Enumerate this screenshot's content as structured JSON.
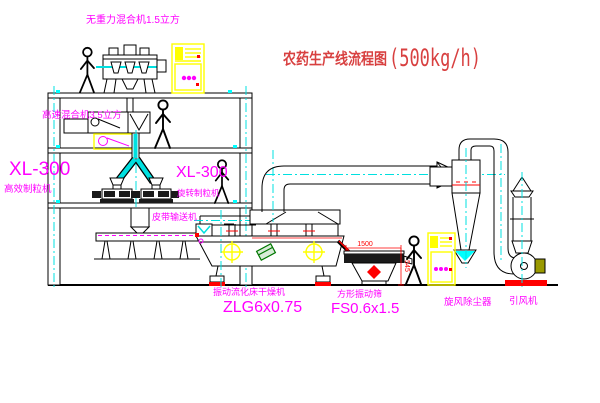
{
  "title": {
    "name": "农药生产线流程图",
    "capacity": "(500kg/h)"
  },
  "labels": {
    "gravity_mixer": "无重力混合机1.5立方",
    "high_speed_mixer": "高速混合机3.5立方",
    "granulator_left_model": "XL-300",
    "granulator_left_name": "高效制粒机",
    "granulator_right_model": "XL-300",
    "granulator_right_name": "旋转制粒机",
    "belt_conveyor": "皮带输送机",
    "dryer_name": "振动流化床干燥机",
    "dryer_model": "ZLG6x0.75",
    "sieve_name": "方形振动筛",
    "sieve_model": "FS0.6x1.5",
    "cyclone": "旋风除尘器",
    "fan": "引风机"
  },
  "dimensions": {
    "sieve_length_mm": "1500",
    "sieve_outlet_height_mm": "545"
  },
  "colors": {
    "line": "#000000",
    "center": "#00e0e0",
    "cyanfill": "#00ffff",
    "label": "#ff00ff",
    "title": "#d84040",
    "dim": "#ff0000",
    "yellow": "#ffff00",
    "green": "#007700",
    "olive": "#9a9a00"
  }
}
